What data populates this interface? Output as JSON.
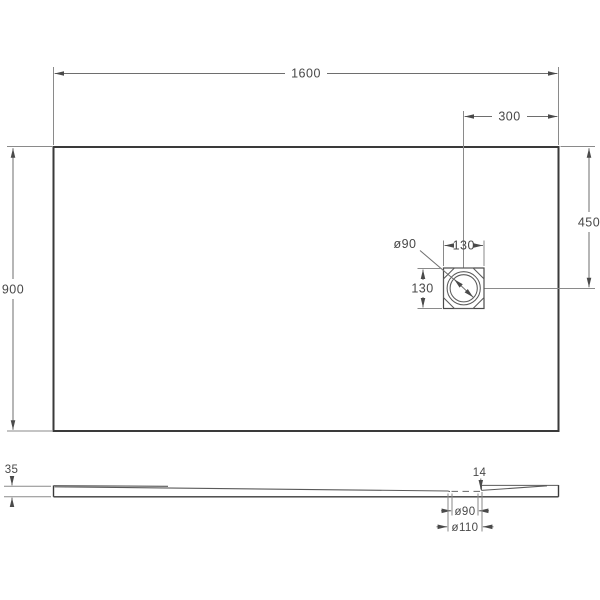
{
  "drawing": {
    "type": "technical-dimension-drawing",
    "subject": "rectangular shower tray, top view and side section view",
    "colors": {
      "background": "#ffffff",
      "outline": "#3a3a3a",
      "dimension_lines": "#6e6e6e",
      "text": "#484848"
    },
    "top_view": {
      "overall_width": "1600",
      "overall_depth": "900",
      "drain_offset_from_right": "300",
      "drain_offset_from_top": "450",
      "drain_box_width": "130",
      "drain_box_height": "130",
      "drain_diameter": "ø90"
    },
    "side_view": {
      "tray_height": "35",
      "drain_lip_height": "14",
      "drain_hole_diameter": "ø90",
      "drain_recess_diameter": "ø110"
    }
  }
}
